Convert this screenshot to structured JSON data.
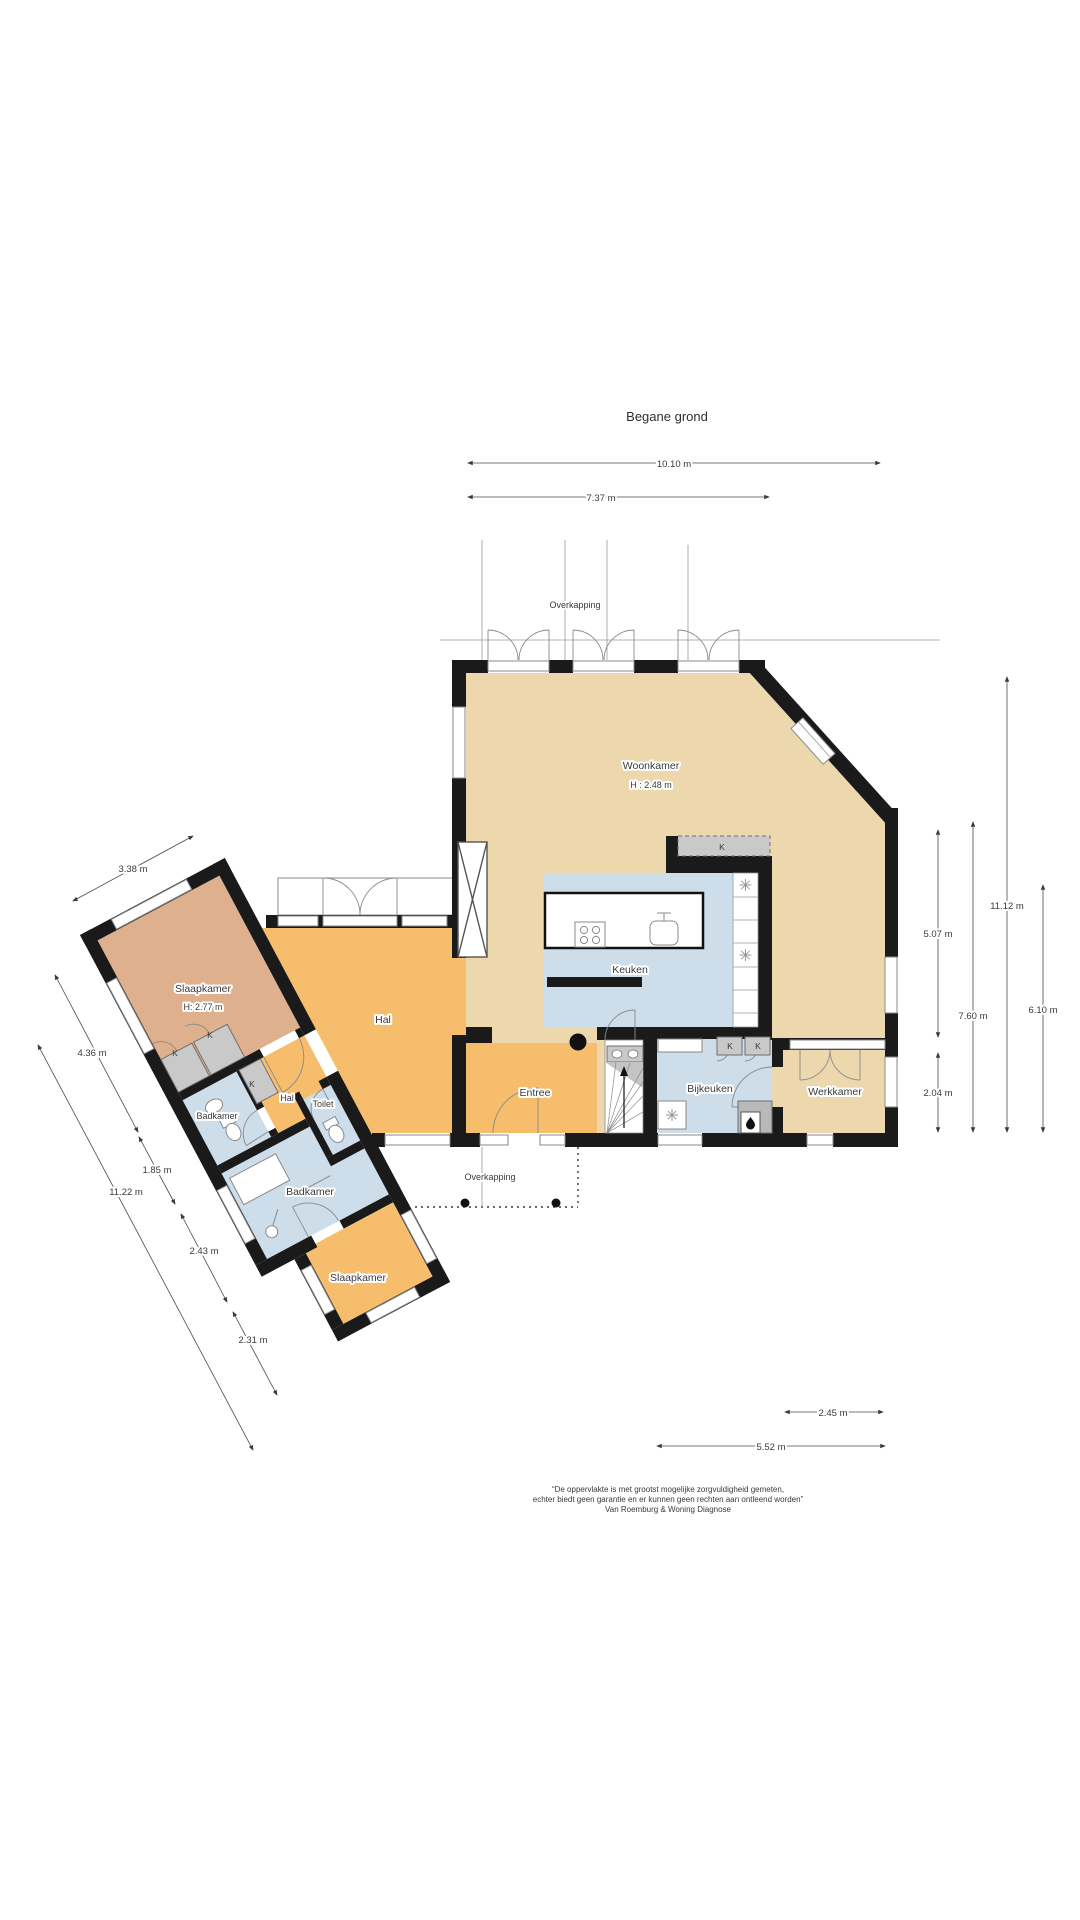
{
  "title": "Begane grond",
  "overkapping_top": "Overkapping",
  "overkapping_bottom": "Overkapping",
  "kast_label": "K",
  "rooms": {
    "woonkamer": {
      "label": "Woonkamer",
      "height": "H : 2.48 m"
    },
    "keuken": {
      "label": "Keuken"
    },
    "bijkeuken": {
      "label": "Bijkeuken"
    },
    "werkkamer": {
      "label": "Werkkamer"
    },
    "entree": {
      "label": "Entree"
    },
    "hal": {
      "label": "Hal"
    },
    "hal_klein": {
      "label": "Hal"
    },
    "slaapkamer_boven": {
      "label": "Slaapkamer",
      "height": "H: 2.77 m"
    },
    "badkamer_klein": {
      "label": "Badkamer"
    },
    "toilet": {
      "label": "Toilet"
    },
    "badkamer_groot": {
      "label": "Badkamer"
    },
    "slaapkamer_onder": {
      "label": "Slaapkamer"
    }
  },
  "dimensions": {
    "top_1010": "10.10 m",
    "top_737": "7.37 m",
    "right_507": "5.07 m",
    "right_760": "7.60 m",
    "right_1112": "11.12 m",
    "right_610": "6.10 m",
    "right_204": "2.04 m",
    "bottom_245": "2.45 m",
    "bottom_552": "5.52 m",
    "wing_338": "3.38 m",
    "wing_436": "4.36 m",
    "wing_185": "1.85 m",
    "wing_1122": "11.22 m",
    "wing_243": "2.43 m",
    "wing_231": "2.31 m"
  },
  "footer": {
    "line1": "“De oppervlakte is met grootst mogelijke zorgvuldigheid gemeten,",
    "line2": "echter biedt geen garantie en er kunnen geen rechten aan ontleend worden”",
    "line3": "Van Roemburg & Woning Diagnose"
  },
  "colors": {
    "wall": "#1a1a1a",
    "beige": "#EDD8AE",
    "orange": "#F6BE6C",
    "blue": "#CDDDEA",
    "salmon": "#DFB08D",
    "closet_grey": "#C9C9C9"
  }
}
